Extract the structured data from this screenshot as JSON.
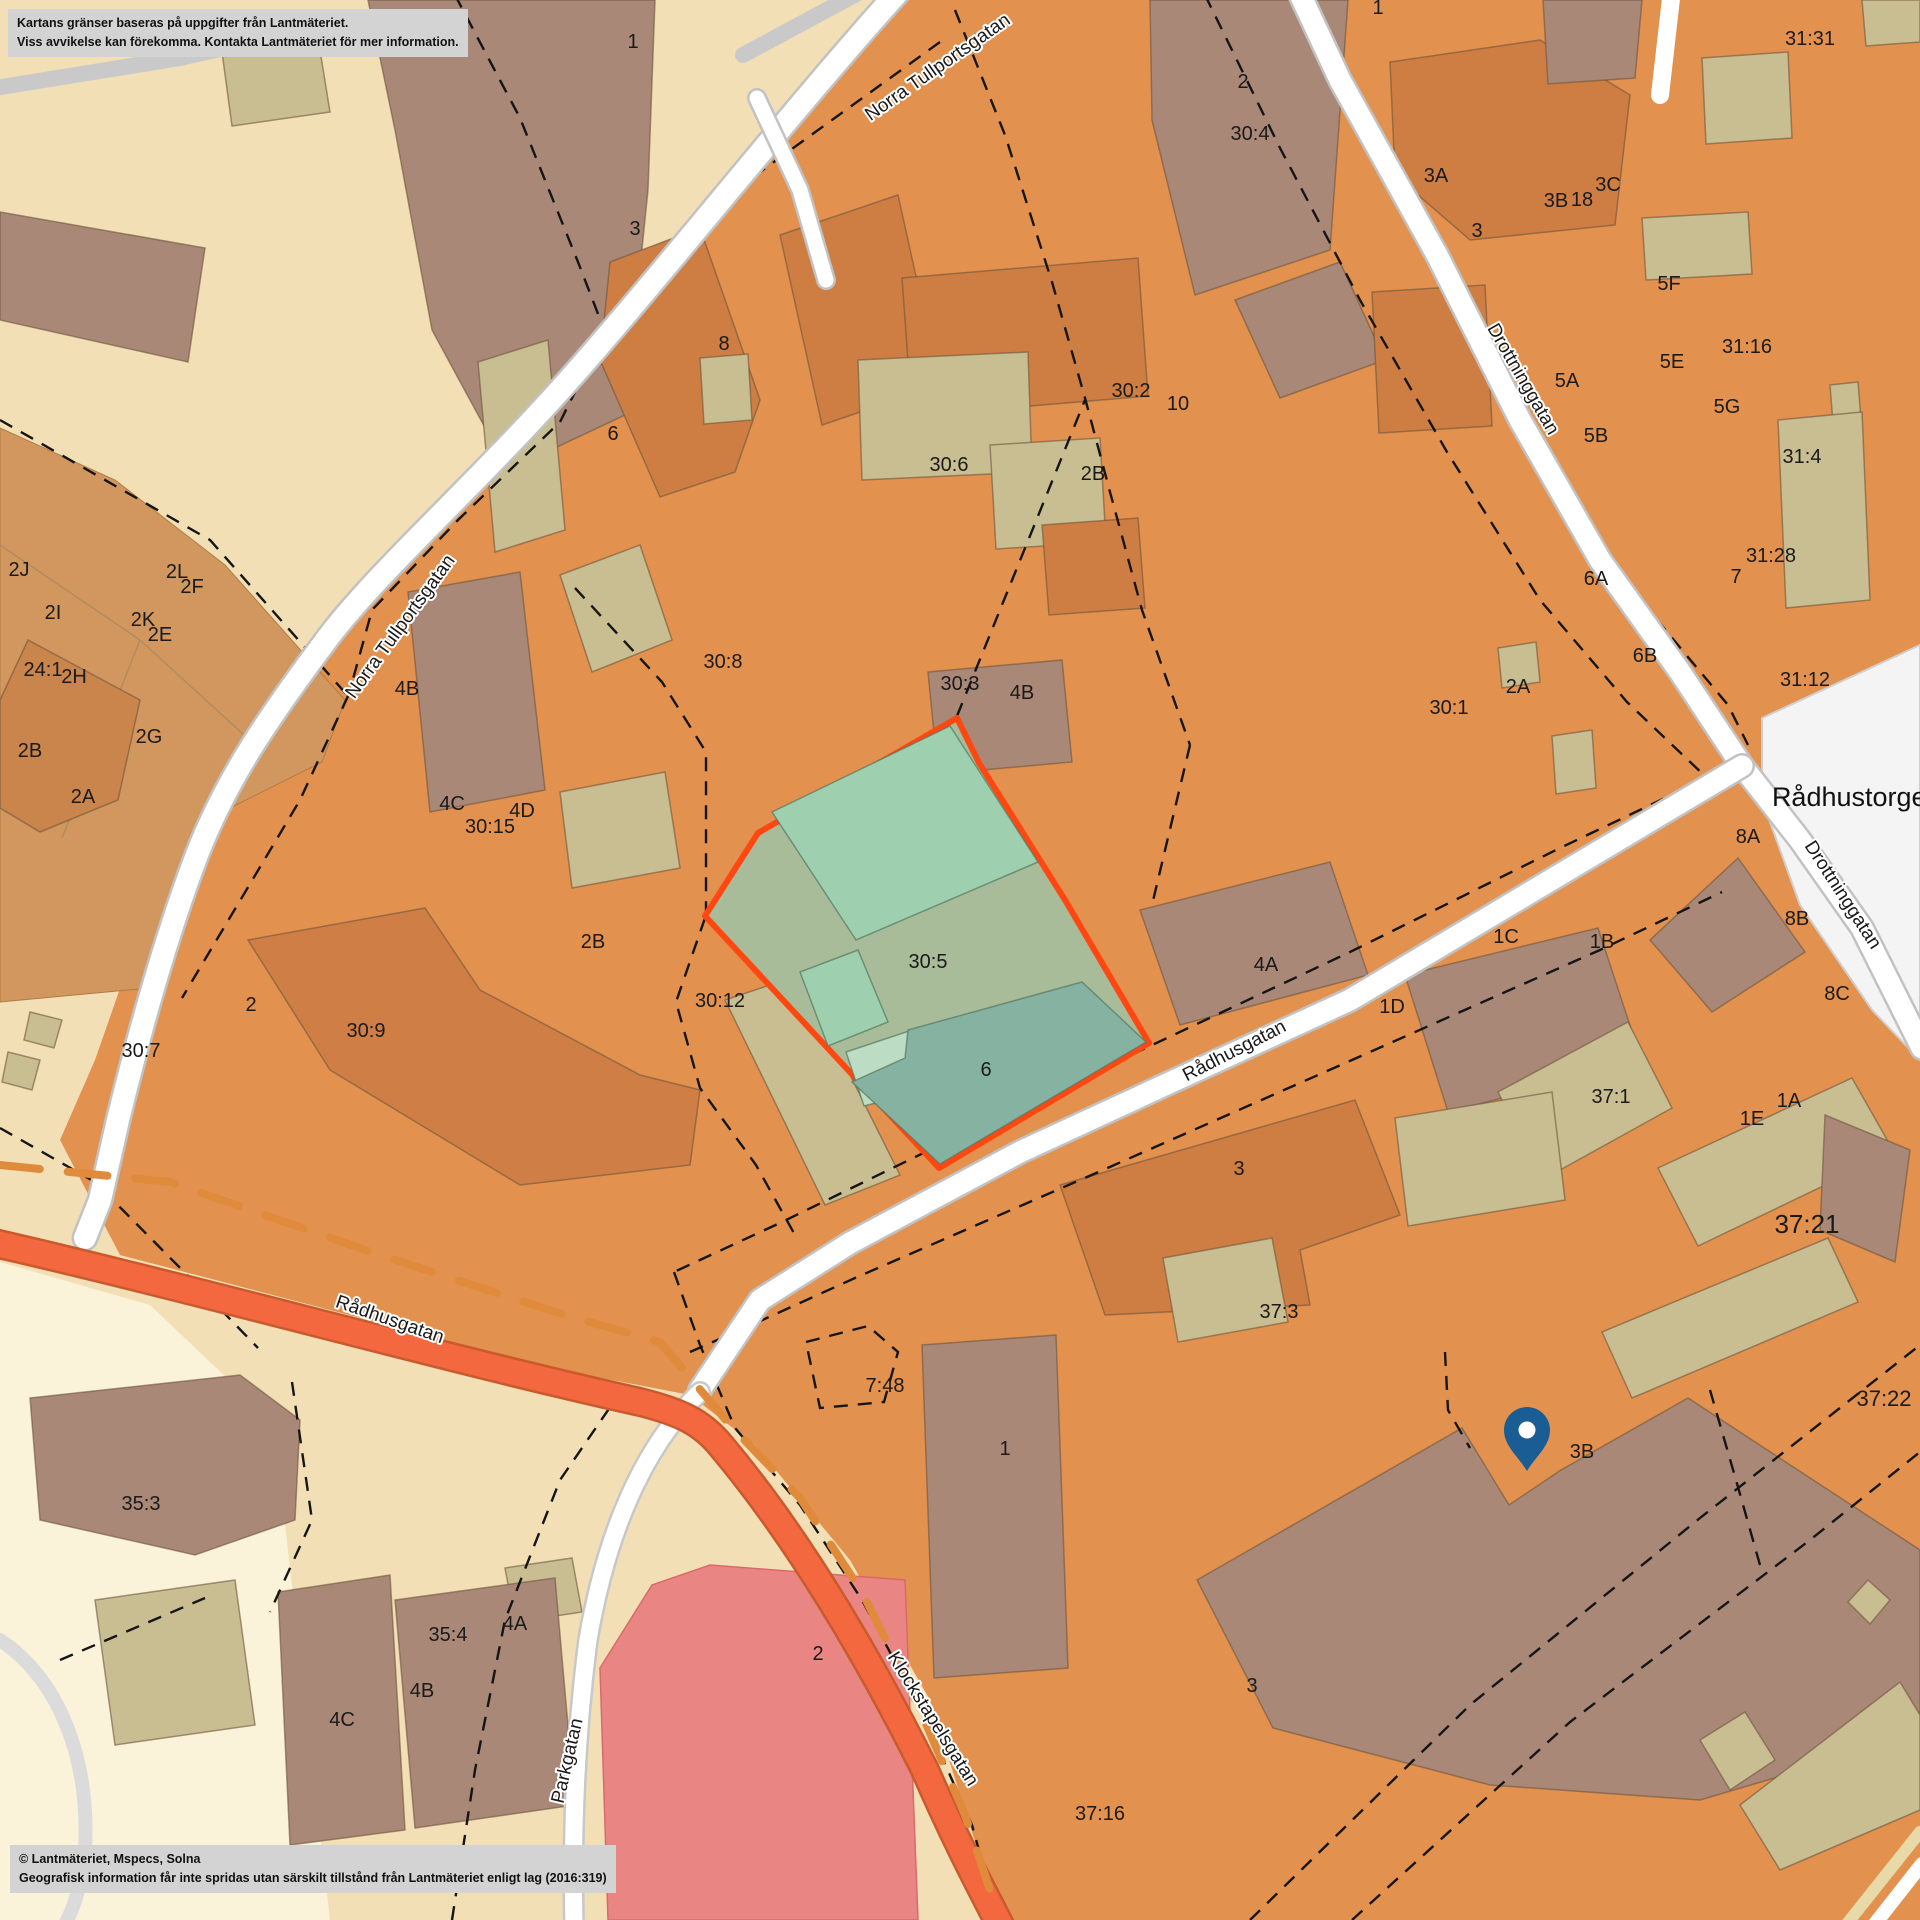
{
  "map": {
    "attribution_box": {
      "line1": "Kartans gränser baseras på uppgifter från Lantmäteriet.",
      "line2": "Viss avvikelse kan förekomma. Kontakta Lantmäteriet för mer information."
    },
    "copyright_box": {
      "line1": "© Lantmäteriet, Mspecs, Solna",
      "line2": "Geografisk information får inte spridas utan särskilt tillstånd från Lantmäteriet enligt lag (2016:319)"
    },
    "place_label": {
      "text": "Rådhustorget",
      "x": 1853,
      "y": 806
    },
    "marker": {
      "icon": "map-pin-icon",
      "x": 1527,
      "y": 1471,
      "color": "#1A5C94"
    },
    "highlighted_parcel": "30:5",
    "street_labels": [
      {
        "text": "Norra Tullportsgatan",
        "x": 941,
        "y": 72,
        "rot": -35
      },
      {
        "text": "Norra Tullportsgatan",
        "x": 405,
        "y": 630,
        "rot": -54
      },
      {
        "text": "Drottninggatan",
        "x": 1518,
        "y": 382,
        "rot": 60
      },
      {
        "text": "Drottninggatan",
        "x": 1838,
        "y": 898,
        "rot": 57
      },
      {
        "text": "Rådhusgatan",
        "x": 1237,
        "y": 1056,
        "rot": -27
      },
      {
        "text": "Rådhusgatan",
        "x": 388,
        "y": 1325,
        "rot": 19
      },
      {
        "text": "Klockstapelsgatan",
        "x": 928,
        "y": 1722,
        "rot": 58
      },
      {
        "text": "Parkgatan",
        "x": 573,
        "y": 1762,
        "rot": -77
      }
    ],
    "parcel_labels": [
      {
        "text": "1",
        "x": 633,
        "y": 48
      },
      {
        "text": "3",
        "x": 635,
        "y": 235
      },
      {
        "text": "8",
        "x": 724,
        "y": 350
      },
      {
        "text": "6",
        "x": 613,
        "y": 440
      },
      {
        "text": "2",
        "x": 1243,
        "y": 88
      },
      {
        "text": "30:4",
        "x": 1250,
        "y": 140
      },
      {
        "text": "10",
        "x": 1178,
        "y": 410
      },
      {
        "text": "30:6",
        "x": 949,
        "y": 471
      },
      {
        "text": "30:8",
        "x": 723,
        "y": 668
      },
      {
        "text": "30:2",
        "x": 1131,
        "y": 397
      },
      {
        "text": "2B",
        "x": 1093,
        "y": 480
      },
      {
        "text": "1",
        "x": 1378,
        "y": 14
      },
      {
        "text": "3A",
        "x": 1436,
        "y": 182
      },
      {
        "text": "3B",
        "x": 1556,
        "y": 207
      },
      {
        "text": "18",
        "x": 1582,
        "y": 206
      },
      {
        "text": "3C",
        "x": 1608,
        "y": 191
      },
      {
        "text": "3",
        "x": 1477,
        "y": 237
      },
      {
        "text": "5F",
        "x": 1669,
        "y": 290
      },
      {
        "text": "31:16",
        "x": 1747,
        "y": 353
      },
      {
        "text": "5E",
        "x": 1672,
        "y": 368
      },
      {
        "text": "5A",
        "x": 1567,
        "y": 387
      },
      {
        "text": "5G",
        "x": 1727,
        "y": 413
      },
      {
        "text": "5B",
        "x": 1596,
        "y": 442
      },
      {
        "text": "31:31",
        "x": 1810,
        "y": 45
      },
      {
        "text": "31:4",
        "x": 1802,
        "y": 463
      },
      {
        "text": "31:28",
        "x": 1771,
        "y": 562
      },
      {
        "text": "7",
        "x": 1736,
        "y": 583
      },
      {
        "text": "6A",
        "x": 1596,
        "y": 585
      },
      {
        "text": "6B",
        "x": 1645,
        "y": 662
      },
      {
        "text": "31:12",
        "x": 1805,
        "y": 686
      },
      {
        "text": "2A",
        "x": 1518,
        "y": 693
      },
      {
        "text": "30:1",
        "x": 1449,
        "y": 714
      },
      {
        "text": "30:3",
        "x": 960,
        "y": 690
      },
      {
        "text": "4B",
        "x": 1022,
        "y": 699
      },
      {
        "text": "4B",
        "x": 407,
        "y": 695
      },
      {
        "text": "4C",
        "x": 452,
        "y": 810
      },
      {
        "text": "4D",
        "x": 522,
        "y": 817
      },
      {
        "text": "30:15",
        "x": 490,
        "y": 833
      },
      {
        "text": "2B",
        "x": 593,
        "y": 948
      },
      {
        "text": "30:12",
        "x": 720,
        "y": 1007
      },
      {
        "text": "2",
        "x": 251,
        "y": 1011
      },
      {
        "text": "30:9",
        "x": 366,
        "y": 1037
      },
      {
        "text": "30:7",
        "x": 141,
        "y": 1057
      },
      {
        "text": "2J",
        "x": 19,
        "y": 576
      },
      {
        "text": "2I",
        "x": 53,
        "y": 619
      },
      {
        "text": "2K",
        "x": 143,
        "y": 626
      },
      {
        "text": "2E",
        "x": 160,
        "y": 641
      },
      {
        "text": "2L",
        "x": 177,
        "y": 578
      },
      {
        "text": "2F",
        "x": 192,
        "y": 593
      },
      {
        "text": "24:1",
        "x": 43,
        "y": 676
      },
      {
        "text": "2H",
        "x": 74,
        "y": 683
      },
      {
        "text": "2B",
        "x": 30,
        "y": 757
      },
      {
        "text": "2G",
        "x": 149,
        "y": 743
      },
      {
        "text": "2A",
        "x": 83,
        "y": 803
      },
      {
        "text": "8A",
        "x": 1748,
        "y": 843
      },
      {
        "text": "8B",
        "x": 1797,
        "y": 925
      },
      {
        "text": "8C",
        "x": 1837,
        "y": 1000
      },
      {
        "text": "1C",
        "x": 1506,
        "y": 943
      },
      {
        "text": "1B",
        "x": 1602,
        "y": 948
      },
      {
        "text": "1D",
        "x": 1392,
        "y": 1013
      },
      {
        "text": "4A",
        "x": 1266,
        "y": 971
      },
      {
        "text": "37:1",
        "x": 1611,
        "y": 1103
      },
      {
        "text": "1A",
        "x": 1789,
        "y": 1107
      },
      {
        "text": "1E",
        "x": 1752,
        "y": 1125
      },
      {
        "text": "37:21",
        "x": 1807,
        "y": 1233,
        "size": 26
      },
      {
        "text": "37:22",
        "x": 1884,
        "y": 1406,
        "size": 22
      },
      {
        "text": "3",
        "x": 1239,
        "y": 1175
      },
      {
        "text": "37:3",
        "x": 1279,
        "y": 1318
      },
      {
        "text": "7:48",
        "x": 885,
        "y": 1392
      },
      {
        "text": "1",
        "x": 1005,
        "y": 1455
      },
      {
        "text": "2",
        "x": 818,
        "y": 1660
      },
      {
        "text": "35:3",
        "x": 141,
        "y": 1510
      },
      {
        "text": "35:4",
        "x": 448,
        "y": 1641
      },
      {
        "text": "4A",
        "x": 515,
        "y": 1630
      },
      {
        "text": "4B",
        "x": 422,
        "y": 1697
      },
      {
        "text": "4C",
        "x": 342,
        "y": 1726
      },
      {
        "text": "3",
        "x": 1252,
        "y": 1692
      },
      {
        "text": "37:16",
        "x": 1100,
        "y": 1820
      },
      {
        "text": "3B",
        "x": 1582,
        "y": 1458
      },
      {
        "text": "30:5",
        "x": 928,
        "y": 968,
        "color": "#37776B"
      },
      {
        "text": "6",
        "x": 986,
        "y": 1076,
        "color": "#37776B"
      }
    ],
    "colors": {
      "base": "#F3DFB5",
      "cream": "#FBF3D9",
      "orange_block": "#E2914E",
      "orange_building": "#CE7E43",
      "brown_building": "#A98877",
      "khaki_building": "#C9BE92",
      "tan_block": "#D2975F",
      "green_ground": "#A8BC9A",
      "green_building": "#9ED0AF",
      "green_mint": "#BCDCC3",
      "teal_building": "#86B2A2",
      "highlight_outline": "#FF4712",
      "road_white": "#FFFFFF",
      "road_orange": "#F4683F",
      "road_gray": "#C9C9C9",
      "red_building": "#E98684",
      "square_white": "#F4F4F4",
      "pin_blue": "#1A5C94",
      "label_teal": "#37776B",
      "dash_orange": "#E08A3C"
    }
  }
}
